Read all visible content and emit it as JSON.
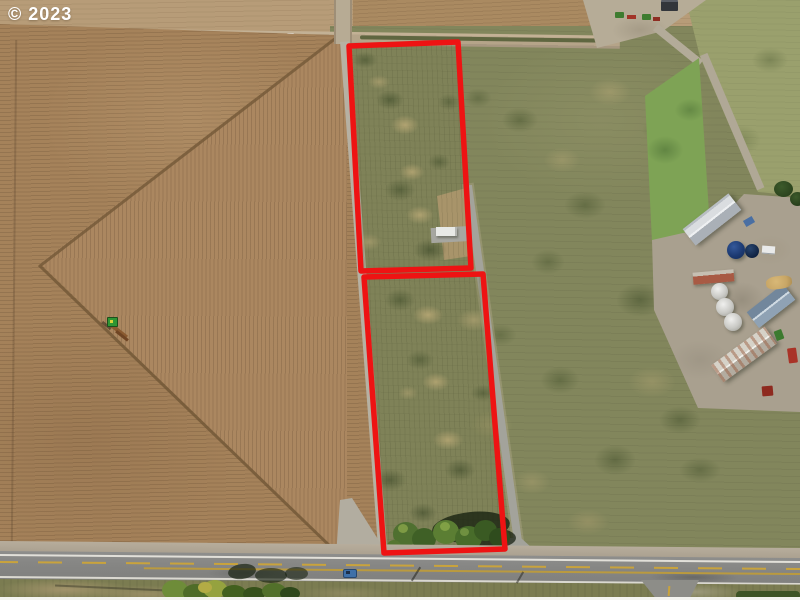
{
  "watermark": {
    "text": "© 2023"
  },
  "annotation": {
    "parcel_count": 2,
    "outline_color": "#ee1313",
    "parcel_upper_points": "349,46 458,42 471,268 361,271",
    "parcel_lower_points": "364,277 483,274 505,549 384,553"
  },
  "colors": {
    "plowed_field_brown": "#a5825a",
    "grass_field_green": "#82865c",
    "pasture_green": "#9aa06d",
    "gravel": "#b3aa99",
    "highway_asphalt": "#858583",
    "edge_line_white": "#e9e7df",
    "center_line_yellow": "#c9a33c",
    "silo_blue": "#1c3a72",
    "barn_roof_white": "#dadde0",
    "barn_roof_bluegray": "#72879c",
    "shed_roof_red": "#a85a44",
    "tree_green": "#3f6026",
    "tractor_green": "#2f9633",
    "truck_red": "#a93327",
    "car_blue": "#3f70a8"
  }
}
